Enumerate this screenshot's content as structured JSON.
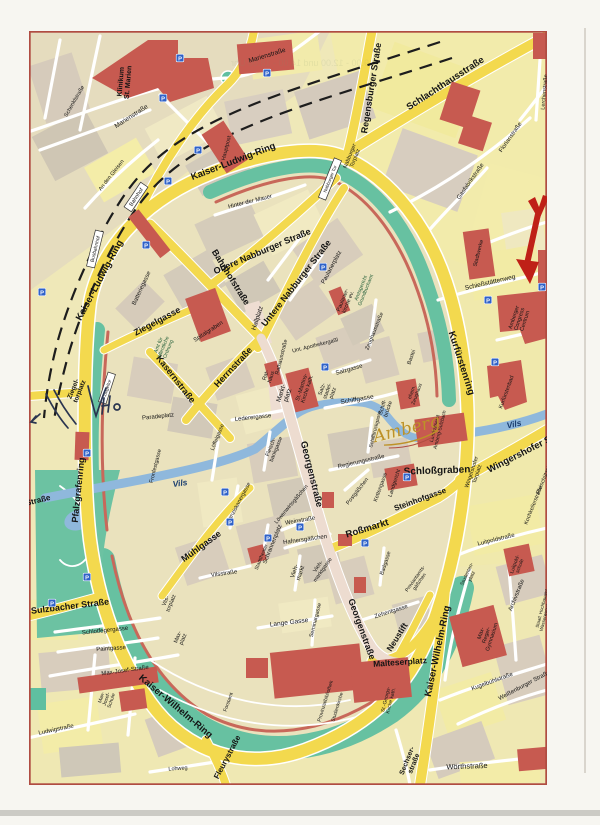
{
  "map": {
    "logo": "Amberg",
    "colors": {
      "ring_road_yellow": "#f3d94e",
      "building_red": "#c75a50",
      "park_green": "#67c1a1",
      "river_blue": "#8fb8dc",
      "block_tan": "#d8cdbc",
      "block_pale_yellow": "#f3eca4",
      "frame_red": "#b04c42",
      "annotation_red": "#bf2017",
      "pen_ink": "#2a3550"
    },
    "labels": [
      {
        "t": "Kaiser-Ludwig-Ring",
        "x": 233,
        "y": 161,
        "r": -21,
        "s": 9.5,
        "w": 700
      },
      {
        "t": "Kaiser-Ludwig-Ring",
        "x": 99,
        "y": 280,
        "r": -62,
        "s": 9.5,
        "w": 700
      },
      {
        "t": "Kurfürstenring",
        "x": 462,
        "y": 363,
        "r": 72,
        "s": 9.5,
        "w": 700
      },
      {
        "t": "Kaiser-Wilhelm-Ring",
        "x": 437,
        "y": 651,
        "r": -78,
        "s": 9.5,
        "w": 700
      },
      {
        "t": "Kaiser-Wilhelm-Ring",
        "x": 176,
        "y": 706,
        "r": 40,
        "s": 9.5,
        "w": 700
      },
      {
        "t": "Pfalzgrafenring",
        "x": 78,
        "y": 490,
        "r": -84,
        "s": 9,
        "w": 700
      },
      {
        "t": "Sulzbacher Straße",
        "x": 70,
        "y": 606,
        "r": -7,
        "s": 9,
        "w": 700
      },
      {
        "t": "Straße",
        "x": 38,
        "y": 500,
        "r": -14,
        "s": 8,
        "w": 700
      },
      {
        "t": "Regensburger Straße",
        "x": 371,
        "y": 88,
        "r": -81,
        "s": 9,
        "w": 700
      },
      {
        "t": "Schlachthausstraße",
        "x": 445,
        "y": 83,
        "r": -33,
        "s": 9.5,
        "w": 700
      },
      {
        "t": "Wingershofer Str.",
        "x": 523,
        "y": 452,
        "r": -27,
        "s": 9.5,
        "w": 700
      },
      {
        "t": "Fleurystraße",
        "x": 227,
        "y": 757,
        "r": -62,
        "s": 8,
        "w": 700
      },
      {
        "t": "Sechser-\nstraße",
        "x": 410,
        "y": 762,
        "r": -68,
        "s": 7,
        "w": 700
      },
      {
        "t": "Wörthstraße",
        "x": 467,
        "y": 766,
        "r": -2,
        "s": 7.5
      },
      {
        "t": "Obere Nabburger Straße",
        "x": 262,
        "y": 251,
        "r": -23,
        "s": 9,
        "w": 700
      },
      {
        "t": "Untere Nabburger Straße",
        "x": 296,
        "y": 283,
        "r": -52,
        "s": 9,
        "w": 700
      },
      {
        "t": "Bahnhofstraße",
        "x": 231,
        "y": 277,
        "r": 58,
        "s": 9,
        "w": 700
      },
      {
        "t": "Herrnstraße",
        "x": 233,
        "y": 367,
        "r": -47,
        "s": 9,
        "w": 700
      },
      {
        "t": "Ziegelgasse",
        "x": 157,
        "y": 321,
        "r": -28,
        "s": 9,
        "w": 700
      },
      {
        "t": "Kasernstraße",
        "x": 176,
        "y": 379,
        "r": 52,
        "s": 9,
        "w": 700
      },
      {
        "t": "Georgenstraße",
        "x": 312,
        "y": 474,
        "r": 76,
        "s": 9.5,
        "w": 700
      },
      {
        "t": "Georgenstraße",
        "x": 362,
        "y": 629,
        "r": 70,
        "s": 9,
        "w": 700
      },
      {
        "t": "Roßmarkt",
        "x": 367,
        "y": 528,
        "r": -17,
        "s": 9.5,
        "w": 700
      },
      {
        "t": "Steinhofgasse",
        "x": 420,
        "y": 499,
        "r": -20,
        "s": 8,
        "w": 700
      },
      {
        "t": "Mühlgasse",
        "x": 201,
        "y": 546,
        "r": -36,
        "s": 9,
        "w": 700
      },
      {
        "t": "Neustift",
        "x": 397,
        "y": 637,
        "r": -58,
        "s": 8.5,
        "w": 700
      },
      {
        "t": "Malteserplatz",
        "x": 400,
        "y": 662,
        "r": -4,
        "s": 8.5,
        "w": 700
      },
      {
        "t": "Schloßgraben",
        "x": 437,
        "y": 470,
        "r": -2,
        "s": 10,
        "w": 700
      },
      {
        "t": "Vils",
        "x": 180,
        "y": 483,
        "r": -8,
        "s": 8.5,
        "w": 700,
        "c": "#1c3f70",
        "i": true
      },
      {
        "t": "Vils",
        "x": 514,
        "y": 424,
        "r": -12,
        "s": 8.5,
        "w": 700,
        "c": "#1c3f70",
        "i": true
      },
      {
        "t": "Hinter der Mauer",
        "x": 250,
        "y": 201,
        "r": -14,
        "s": 6
      },
      {
        "t": "Batteriegasse",
        "x": 141,
        "y": 288,
        "r": -65,
        "s": 6
      },
      {
        "t": "Spitalgraben",
        "x": 208,
        "y": 331,
        "r": -33,
        "s": 6
      },
      {
        "t": "Hallplatz",
        "x": 257,
        "y": 318,
        "r": -72,
        "s": 6.5
      },
      {
        "t": "Rathausstraße",
        "x": 281,
        "y": 357,
        "r": -76,
        "s": 5.5
      },
      {
        "t": "Markt-\nplatz",
        "x": 284,
        "y": 394,
        "r": -72,
        "s": 6.5
      },
      {
        "t": "Rat-\nhaus",
        "x": 268,
        "y": 376,
        "r": -72,
        "s": 5.5
      },
      {
        "t": "St.-Martins-\nKirche kath.",
        "x": 304,
        "y": 388,
        "r": -72,
        "s": 5.5
      },
      {
        "t": "Salz-\nstadel-\nplatz",
        "x": 327,
        "y": 391,
        "r": -70,
        "s": 5.5
      },
      {
        "t": "Salzgasse",
        "x": 349,
        "y": 369,
        "r": -16,
        "s": 6
      },
      {
        "t": "Schiffgasse",
        "x": 357,
        "y": 399,
        "r": -10,
        "s": 6.5
      },
      {
        "t": "Unt. Apothekergaßl",
        "x": 315,
        "y": 345,
        "r": -14,
        "s": 5.5
      },
      {
        "t": "Lederergasse",
        "x": 253,
        "y": 417,
        "r": -6,
        "s": 6
      },
      {
        "t": "Löwenwirtsgäßchen",
        "x": 291,
        "y": 504,
        "r": -50,
        "s": 5.5
      },
      {
        "t": "Weinstraße",
        "x": 300,
        "y": 520,
        "r": -10,
        "s": 6
      },
      {
        "t": "Hafnersgäßchen",
        "x": 305,
        "y": 539,
        "r": -8,
        "s": 6
      },
      {
        "t": "Postgäßchen",
        "x": 357,
        "y": 491,
        "r": -52,
        "s": 5.5
      },
      {
        "t": "Regierungsstraße",
        "x": 361,
        "y": 461,
        "r": -13,
        "s": 6
      },
      {
        "t": "Franziskanergasse",
        "x": 238,
        "y": 503,
        "r": -62,
        "s": 5.5
      },
      {
        "t": "Schrannenplatz",
        "x": 272,
        "y": 544,
        "r": -68,
        "s": 6
      },
      {
        "t": "Stadttheater",
        "x": 261,
        "y": 557,
        "r": -68,
        "s": 5
      },
      {
        "t": "Vilsstraße",
        "x": 224,
        "y": 573,
        "r": -8,
        "s": 6
      },
      {
        "t": "Vieh-\nmarkt",
        "x": 297,
        "y": 572,
        "r": -72,
        "s": 6
      },
      {
        "t": "Vieh-\nmarktgasse",
        "x": 320,
        "y": 568,
        "r": -55,
        "s": 5.5
      },
      {
        "t": "Fleisch-\nbankgasse",
        "x": 273,
        "y": 448,
        "r": -68,
        "s": 5.5
      },
      {
        "t": "Löffelgasse",
        "x": 217,
        "y": 437,
        "r": -68,
        "s": 5.5
      },
      {
        "t": "Zehentgasse",
        "x": 391,
        "y": 611,
        "r": -18,
        "s": 6
      },
      {
        "t": "Lange Gasse",
        "x": 289,
        "y": 622,
        "r": -7,
        "s": 6.5
      },
      {
        "t": "Seminargasse",
        "x": 315,
        "y": 620,
        "r": -76,
        "s": 5.5
      },
      {
        "t": "Proviantamts-\ngäßchen",
        "x": 417,
        "y": 580,
        "r": -55,
        "s": 5
      },
      {
        "t": "Badgasse",
        "x": 385,
        "y": 563,
        "r": -72,
        "s": 5.5
      },
      {
        "t": "Kettengasse",
        "x": 380,
        "y": 487,
        "r": -70,
        "s": 5.5
      },
      {
        "t": "Landgericht",
        "x": 394,
        "y": 483,
        "r": -72,
        "s": 5.5
      },
      {
        "t": "Schiff-\nbrücke",
        "x": 385,
        "y": 408,
        "r": -72,
        "s": 5.5
      },
      {
        "t": "Schiffbrückgasse",
        "x": 375,
        "y": 429,
        "r": -76,
        "s": 5
      },
      {
        "t": "Zeughausstraße",
        "x": 374,
        "y": 331,
        "r": -68,
        "s": 5.5
      },
      {
        "t": "Paulanerplatz",
        "x": 331,
        "y": 267,
        "r": -62,
        "s": 6
      },
      {
        "t": "Paulaner-\nkirche ev.",
        "x": 345,
        "y": 301,
        "r": -68,
        "s": 5.5
      },
      {
        "t": "Amtsgericht\nGrundbuchamt",
        "x": 363,
        "y": 289,
        "r": -68,
        "s": 5,
        "c": "#1d5b35"
      },
      {
        "t": "Amt für\nöffentliche\nOrdnung",
        "x": 163,
        "y": 347,
        "r": -68,
        "s": 5,
        "c": "#1d5b35"
      },
      {
        "t": "Paradeplatz",
        "x": 158,
        "y": 416,
        "r": -6,
        "s": 6
      },
      {
        "t": "Fronfestgasse",
        "x": 155,
        "y": 466,
        "r": -76,
        "s": 5.5
      },
      {
        "t": "Ziegel-\ntorplatz",
        "x": 76,
        "y": 390,
        "r": -68,
        "s": 6.5,
        "w": 700
      },
      {
        "t": "Vils-\ntorplatz",
        "x": 168,
        "y": 602,
        "r": -68,
        "s": 5.5
      },
      {
        "t": "Max-\nplatz",
        "x": 180,
        "y": 638,
        "r": -68,
        "s": 5.5
      },
      {
        "t": "Schlotfegergasse",
        "x": 105,
        "y": 630,
        "r": -6,
        "s": 6
      },
      {
        "t": "Paintgasse",
        "x": 111,
        "y": 648,
        "r": -4,
        "s": 6
      },
      {
        "t": "Max-Josef-Straße",
        "x": 125,
        "y": 670,
        "r": -8,
        "s": 6
      },
      {
        "t": "Max-\nJosef-\nSchule",
        "x": 106,
        "y": 699,
        "r": -72,
        "s": 5
      },
      {
        "t": "Ludwigstraße",
        "x": 56,
        "y": 729,
        "r": -12,
        "s": 6
      },
      {
        "t": "Lohweg",
        "x": 178,
        "y": 768,
        "r": -4,
        "s": 5.5
      },
      {
        "t": "Forstamt",
        "x": 228,
        "y": 702,
        "r": -70,
        "s": 5
      },
      {
        "t": "Wingershofer\nTorplatz",
        "x": 474,
        "y": 473,
        "r": -72,
        "s": 5.5
      },
      {
        "t": "Kurfürstenbad",
        "x": 506,
        "y": 392,
        "r": -70,
        "s": 5.5
      },
      {
        "t": "Landratsamt\nAmberg-Sulzbach",
        "x": 437,
        "y": 429,
        "r": -76,
        "s": 5
      },
      {
        "t": "ehem.\nZeughaus",
        "x": 414,
        "y": 393,
        "r": -70,
        "s": 5
      },
      {
        "t": "Bastei",
        "x": 411,
        "y": 357,
        "r": -70,
        "s": 5.5
      },
      {
        "t": "Schießstättenweg",
        "x": 490,
        "y": 282,
        "r": -13,
        "s": 6.5
      },
      {
        "t": "Amberger\nCongress\nCentrum",
        "x": 519,
        "y": 319,
        "r": -72,
        "s": 5.5
      },
      {
        "t": "Stadtwerke",
        "x": 478,
        "y": 253,
        "r": -76,
        "s": 5.5
      },
      {
        "t": "Gasfabrikstraße",
        "x": 470,
        "y": 181,
        "r": -55,
        "s": 6
      },
      {
        "t": "Florianstraße",
        "x": 510,
        "y": 137,
        "r": -55,
        "s": 6
      },
      {
        "t": "Lerchenstraße",
        "x": 544,
        "y": 92,
        "r": -85,
        "s": 5.5
      },
      {
        "t": "Nabburger\nTorplatz",
        "x": 352,
        "y": 157,
        "r": -68,
        "s": 5.5
      },
      {
        "t": "Klinikum\nSt. Marien",
        "x": 124,
        "y": 82,
        "r": -85,
        "s": 7,
        "w": 700
      },
      {
        "t": "Marienstraße",
        "x": 267,
        "y": 55,
        "r": -17,
        "s": 6.5
      },
      {
        "t": "Marienstraße",
        "x": 131,
        "y": 116,
        "r": -33,
        "s": 6.5
      },
      {
        "t": "Schenklstraße",
        "x": 74,
        "y": 101,
        "r": -60,
        "s": 5.5
      },
      {
        "t": "An den Gleisen",
        "x": 111,
        "y": 175,
        "r": -52,
        "s": 5.5
      },
      {
        "t": "Hauptpost",
        "x": 226,
        "y": 148,
        "r": -76,
        "s": 5.5
      },
      {
        "t": "Luitpoldstraße",
        "x": 496,
        "y": 539,
        "r": -14,
        "s": 6
      },
      {
        "t": "Luitpold-\nschule",
        "x": 517,
        "y": 565,
        "r": -70,
        "s": 5
      },
      {
        "t": "Kochkellerstraße",
        "x": 533,
        "y": 505,
        "r": -68,
        "s": 5.5
      },
      {
        "t": "Freischützstraße",
        "x": 545,
        "y": 475,
        "r": -68,
        "s": 5.5
      },
      {
        "t": "Kugelbühlstraße",
        "x": 492,
        "y": 681,
        "r": -20,
        "s": 6
      },
      {
        "t": "Weißenburger Straße",
        "x": 524,
        "y": 685,
        "r": -28,
        "s": 6
      },
      {
        "t": "Archivstraße",
        "x": 516,
        "y": 595,
        "r": -68,
        "s": 6
      },
      {
        "t": "Max-\nReger-\nGymnasium",
        "x": 486,
        "y": 635,
        "r": -72,
        "s": 5.5
      },
      {
        "t": "Staatl. Hochbauamt\nWasserwirtschaftsamt",
        "x": 544,
        "y": 609,
        "r": -76,
        "s": 4.5
      },
      {
        "t": "Studenten-\nplatz",
        "x": 469,
        "y": 575,
        "r": -65,
        "s": 5
      },
      {
        "t": "St.-Georgs-\nKirche kath.",
        "x": 388,
        "y": 700,
        "r": -76,
        "s": 5
      },
      {
        "t": "Provinzialbibliothek",
        "x": 325,
        "y": 701,
        "r": -73,
        "s": 5
      },
      {
        "t": "Studienkirche",
        "x": 337,
        "y": 707,
        "r": -73,
        "s": 5
      },
      {
        "t": "Bahnhof",
        "x": 136,
        "y": 197,
        "r": -56,
        "s": 5.5,
        "b": true
      },
      {
        "t": "Busbahnhof",
        "x": 95,
        "y": 249,
        "r": -76,
        "s": 5,
        "b": true
      },
      {
        "t": "Ziegeltor",
        "x": 107,
        "y": 388,
        "r": -72,
        "s": 4.5,
        "b": true
      },
      {
        "t": "Nabburger Tor",
        "x": 330,
        "y": 179,
        "r": -68,
        "s": 4.5,
        "b": true
      }
    ],
    "parking": {
      "glyph": "P",
      "color": "#2f62c8",
      "spots": [
        [
          180,
          58
        ],
        [
          267,
          73
        ],
        [
          163,
          98
        ],
        [
          198,
          150
        ],
        [
          168,
          181
        ],
        [
          146,
          245
        ],
        [
          323,
          267
        ],
        [
          325,
          367
        ],
        [
          225,
          492
        ],
        [
          230,
          522
        ],
        [
          268,
          538
        ],
        [
          300,
          527
        ],
        [
          365,
          543
        ],
        [
          407,
          477
        ],
        [
          495,
          362
        ],
        [
          488,
          300
        ],
        [
          542,
          287
        ],
        [
          42,
          292
        ],
        [
          87,
          453
        ],
        [
          87,
          577
        ],
        [
          52,
          603
        ]
      ]
    },
    "scan_artifacts": {
      "ghost_lines": [
        {
          "t": "9.00 - 12.00 und 14.00 - 18.00 Uhr",
          "x": 300,
          "y": 66,
          "r": 0,
          "s": 9
        },
        {
          "t": "Regensburger",
          "x": 580,
          "y": 360,
          "r": 90,
          "s": 9
        },
        {
          "t": "Samstag 9.00 - 12.00 Uhr",
          "x": 210,
          "y": 801,
          "r": 0,
          "s": 8
        }
      ]
    }
  }
}
